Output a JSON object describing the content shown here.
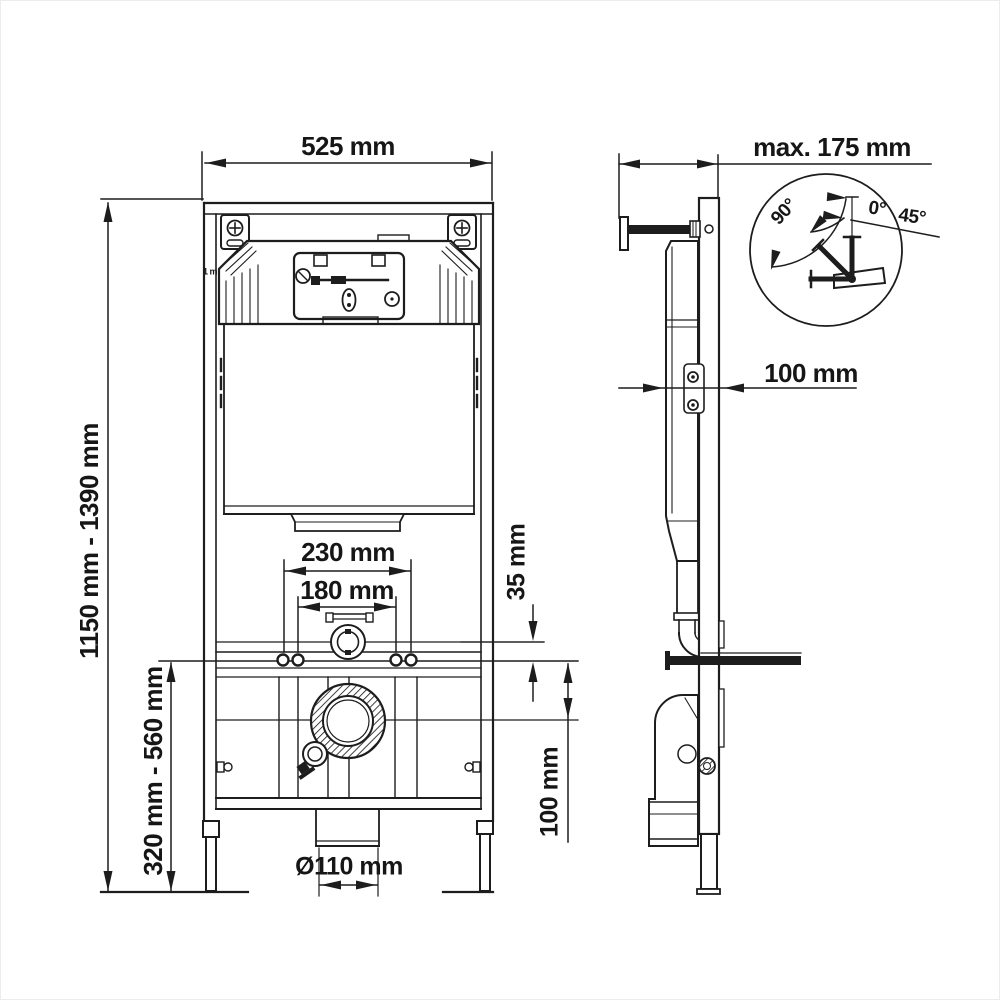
{
  "drawing_type": "technical-installation-drawing",
  "front_view": {
    "width": "525 mm",
    "height_range": "1150 mm - 1390 mm",
    "lower_height_range": "320 mm - 560 mm",
    "bolt_spacing_outer": "230 mm",
    "bolt_spacing_inner": "180 mm",
    "flush_bend_offset": "35 mm",
    "outlet_center_height": "100 mm",
    "outlet_diameter": "Ø110 mm",
    "meter_mark": "1 m"
  },
  "side_view": {
    "max_depth": "max. 175 mm",
    "wall_distance": "100 mm"
  },
  "angle_detail": {
    "max_angle": "90°",
    "zero_angle": "0°",
    "mid_angle": "45°"
  },
  "colors": {
    "line": "#1d1d1d",
    "background": "#ffffff"
  }
}
